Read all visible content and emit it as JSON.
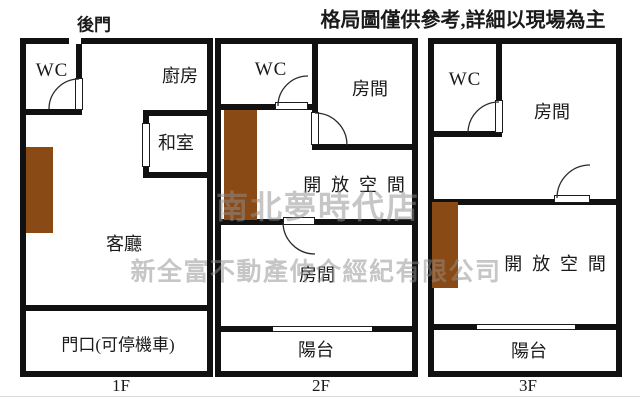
{
  "header": {
    "disclaimer": "格局圖僅供參考,詳細以現場為主",
    "back_door": "後門"
  },
  "watermark": {
    "store": "南北夢時代店",
    "company": "新全富不動產仲介經紀有限公司"
  },
  "colors": {
    "wall": "#111111",
    "stairs": "#8a4a15",
    "watermark": "#8f8f8f"
  },
  "floors": {
    "f1": {
      "label": "1F",
      "wc": "WC",
      "kitchen": "廚房",
      "tatami": "和室",
      "living_room": "客廳",
      "entrance": "門口(可停機車)"
    },
    "f2": {
      "label": "2F",
      "wc": "WC",
      "room_top": "房間",
      "open_space": "開放空間",
      "room_bottom": "房間",
      "balcony": "陽台"
    },
    "f3": {
      "label": "3F",
      "wc": "WC",
      "room": "房間",
      "open_space": "開放空間",
      "balcony": "陽台"
    }
  }
}
